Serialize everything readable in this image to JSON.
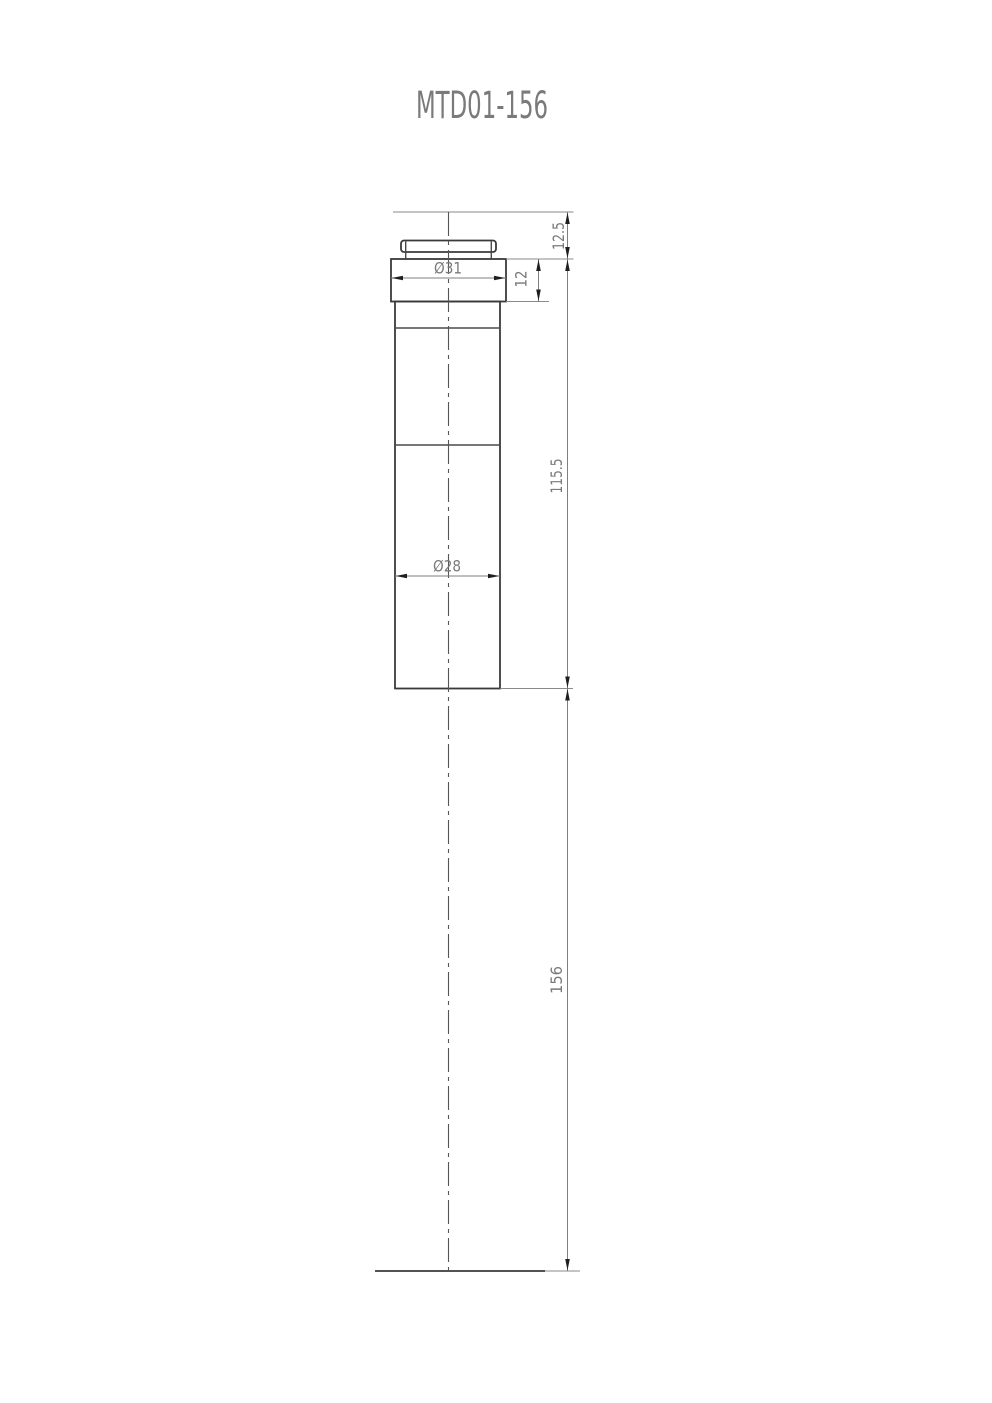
{
  "drawing": {
    "title": "MTD01-156",
    "dimensions": {
      "top_offset": "12.5",
      "flange_thickness": "12",
      "flange_diameter": "Ø31",
      "body_length": "115.5",
      "body_diameter": "Ø28",
      "overall_length": "156"
    },
    "colors": {
      "background": "#ffffff",
      "outline": "#3a3a3a",
      "thin_line": "#8a8a8a",
      "center_line": "#555555",
      "arrow": "#1f1f1f",
      "text": "#7a7a7a"
    }
  }
}
